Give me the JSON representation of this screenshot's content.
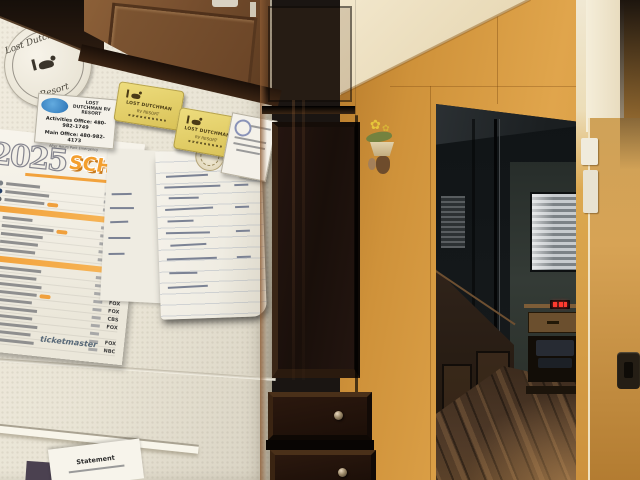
{
  "scene_description": "Kitchen corner photo: refrigerator covered with resort papers and a 2025 game schedule, dark espresso pantry cabinet, and a hallway with wood floor seen through a doorway",
  "fridge": {
    "round_magnet": {
      "top": "Lost Dutchman's",
      "bottom": "Resort"
    },
    "info_card": {
      "org": "LOST DUTCHMAN RV RESORT",
      "line1": "Activities Office: 480-982-1749",
      "line2": "Main Office: 480-982-4173",
      "line3": "After Hours Park Emergency"
    },
    "yellow_magnets": [
      {
        "line1": "LOST DUTCHMAN",
        "line2": "RV RESORT"
      },
      {
        "line1": "LOST DUTCHMAN",
        "line2": "RV RESORT"
      }
    ],
    "schedule": {
      "year": "2025",
      "title": "SCHEDULE",
      "footer": "ticketmaster",
      "rows": [
        {
          "logo": "#7d8287",
          "w": 34,
          "net": "CBS"
        },
        {
          "logo": "#243e66",
          "w": 44,
          "net": "FOX"
        },
        {
          "logo": "#5c5f63",
          "w": 40,
          "net": "FOX",
          "tag": true
        },
        {
          "bar": true
        },
        {
          "logo": "#3a3d42",
          "w": 30,
          "net": ""
        },
        {
          "logo": "#6b1f2a",
          "w": 52,
          "net": "NBC",
          "tag": true
        },
        {
          "logo": "#b02a30",
          "w": 42,
          "net": "FOX"
        },
        {
          "logo": "#1d2d50",
          "w": 38,
          "net": "CBS"
        },
        {
          "logo": "#caa83c",
          "w": 36,
          "net": ""
        },
        {
          "bar": true
        },
        {
          "logo": "#d86a1f",
          "w": 44,
          "net": "CBS"
        },
        {
          "logo": "#27406b",
          "w": 40,
          "net": "FOX"
        },
        {
          "logo": "#8a8d90",
          "w": 46,
          "net": "NBC"
        },
        {
          "logo": "#13294b",
          "w": 42,
          "net": "FOX",
          "tag": true
        },
        {
          "logo": "#b3995d",
          "w": 38,
          "net": "FOX"
        },
        {
          "logo": "#2a6e4a",
          "w": 44,
          "net": "CBS"
        },
        {
          "logo": "#c8102e",
          "w": 40,
          "net": "FOX"
        },
        {
          "logo": "#3a2a6b",
          "w": 46,
          "net": ""
        },
        {
          "logo": "#6b4226",
          "w": 40,
          "net": "FOX"
        },
        {
          "logo": "#27406b",
          "w": 44,
          "net": "NBC"
        }
      ]
    },
    "statement_paper": {
      "title": "Statement"
    }
  },
  "colors": {
    "wall": "#d0923c",
    "ceiling": "#f2e7cc",
    "fridge": "#e9e4d5",
    "pantry_cabinet": "#1d110b",
    "upper_cabinet": "#7a5130",
    "floor": "#4d3827",
    "schedule_orange": "#f49f2e",
    "card_blue": "#2a72b5",
    "magnet_yellow": "#e3cf69",
    "led_red": "#ff3b30"
  }
}
